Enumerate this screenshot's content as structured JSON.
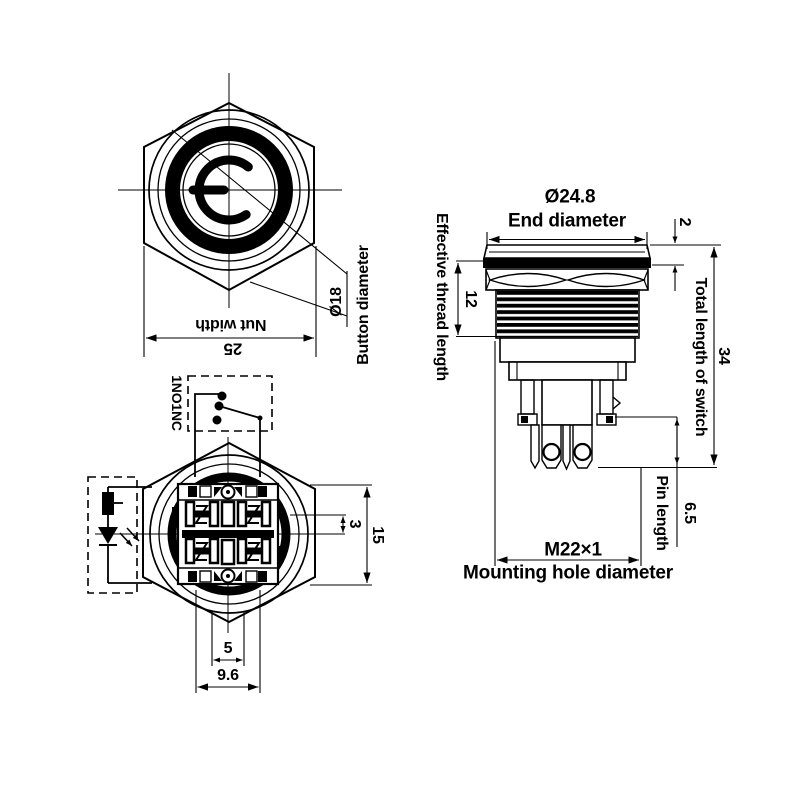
{
  "page": {
    "background_color": "#ffffff",
    "line_color": "#000000",
    "drawing_type": "push-button switch dimensional drawing"
  },
  "front_view": {
    "nut_width_label": "Nut width",
    "nut_width_value": "25",
    "button_diameter_value": "Ø18",
    "button_diameter_label": "Button diameter"
  },
  "rear_view": {
    "contact_configuration": "1NO1NC",
    "terminal_offset_value": "3",
    "terminal_block_value": "15",
    "pin_spacing_small_value": "5",
    "pin_spacing_large_value": "9.6"
  },
  "side_view": {
    "end_diameter_value": "Ø24.8",
    "end_diameter_label": "End diameter",
    "head_height_value": "2",
    "effective_thread_label": "Effective thread length",
    "effective_thread_value": "12",
    "total_length_label": "Total length of switch",
    "total_length_value": "34",
    "pin_length_label": "Pin length",
    "pin_length_value": "6.5",
    "mounting_hole_value": "M22×1",
    "mounting_hole_label": "Mounting hole diameter"
  }
}
